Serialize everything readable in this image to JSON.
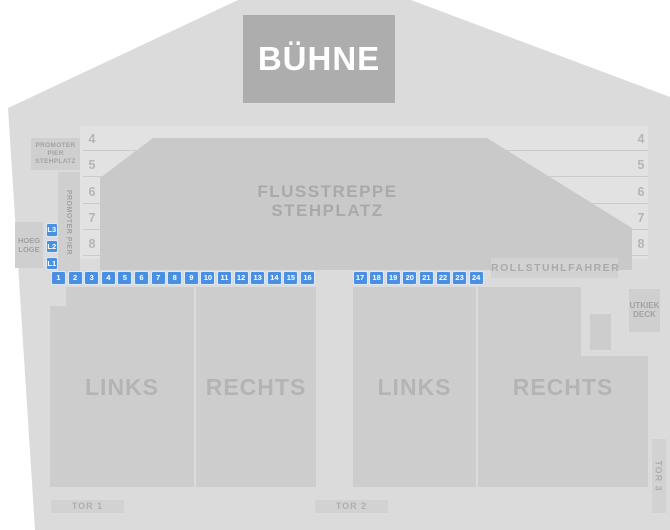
{
  "stage": {
    "label": "BÜHNE"
  },
  "areas": {
    "flusstreppe": {
      "line1": "FLUSSTREPPE",
      "line2": "STEHPLATZ"
    },
    "promoter_pier_stehplatz": {
      "line1": "PROMOTER",
      "line2": "PIER",
      "line3": "STEHPLATZ"
    },
    "promoter_pier": {
      "label": "PROMOTER PIER"
    },
    "hoeg_loge": {
      "line1": "HOEG",
      "line2": "LOGE"
    },
    "rollstuhlfahrer": {
      "label": "ROLLSTUHLFAHRER"
    },
    "utkiek_deck": {
      "line1": "UTKIEK",
      "line2": "DECK"
    }
  },
  "sections": [
    {
      "label": "LINKS"
    },
    {
      "label": "RECHTS"
    },
    {
      "label": "LINKS"
    },
    {
      "label": "RECHTS"
    }
  ],
  "gates": {
    "tor1": "TOR 1",
    "tor2": "TOR 2",
    "tor3": "TOR 3"
  },
  "rows": {
    "labels": [
      "4",
      "5",
      "6",
      "7",
      "8"
    ]
  },
  "seats": {
    "loge": [
      "L3",
      "L2",
      "L1"
    ],
    "left": [
      "1",
      "2",
      "3",
      "4",
      "5",
      "6",
      "7",
      "8",
      "9",
      "10",
      "11",
      "12",
      "13",
      "14",
      "15",
      "16"
    ],
    "right": [
      "17",
      "18",
      "19",
      "20",
      "21",
      "22",
      "23",
      "24"
    ]
  },
  "colors": {
    "seat_available": "#4a90e2",
    "area_gray": "#cdcdcd",
    "stage_gray": "#adadad",
    "venue_gray": "#dbdbdb"
  }
}
